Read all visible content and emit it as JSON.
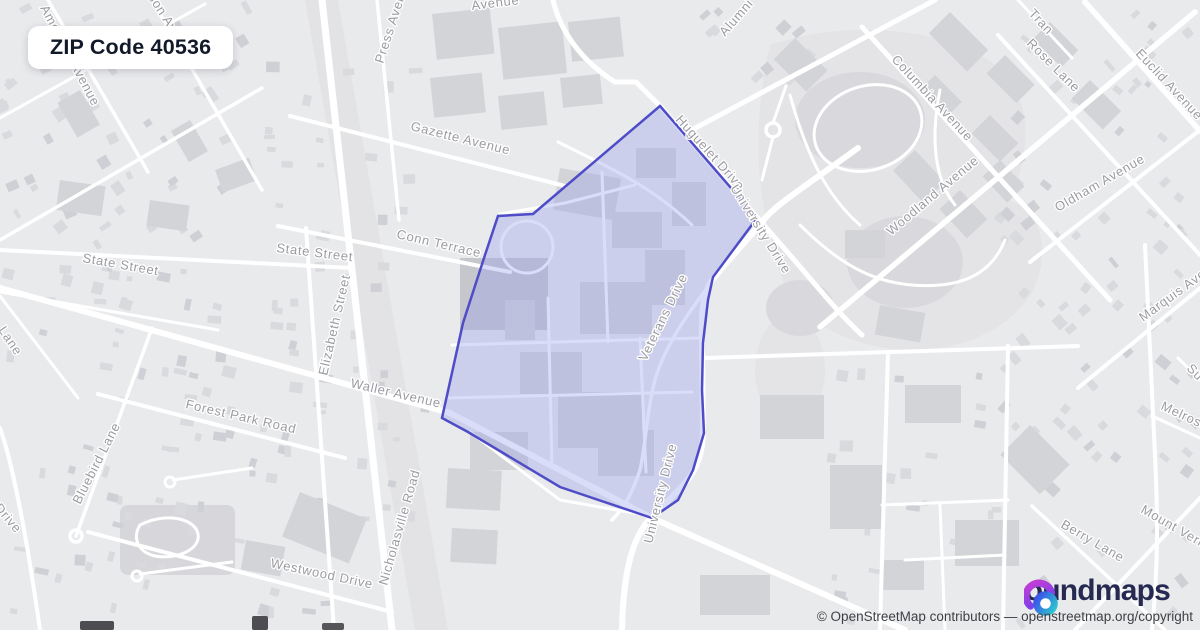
{
  "card": {
    "title": "ZIP Code 40536"
  },
  "branding": {
    "logo_full": "boundmaps",
    "logo_text": "oundmaps",
    "icon": "boundmaps-icon"
  },
  "attribution": {
    "text": "© OpenStreetMap contributors — openstreetmap.org/copyright"
  },
  "map": {
    "colors": {
      "background": "#e9eaec",
      "road": "#ffffff",
      "building": "#d3d4d8",
      "label": "#9b9ba2",
      "boundary_stroke": "#4f4cc8",
      "boundary_fill": "rgba(150,157,235,0.35)"
    },
    "zip_boundary": {
      "zip": "40536",
      "points": "660,106 757,218 713,277 708,300 703,343 702,390 704,433 693,470 678,500 652,518 560,487 468,432 442,418 463,323 485,255 498,216 533,214"
    },
    "street_labels": [
      {
        "text": "American Avenue",
        "x": 40,
        "y": 8,
        "rot": 62
      },
      {
        "text": "Simpson Avenue",
        "x": 130,
        "y": -30,
        "rot": 57
      },
      {
        "text": "Avenue",
        "x": 472,
        "y": 10,
        "rot": -7
      },
      {
        "text": "Press Avenue",
        "x": 383,
        "y": 64,
        "rot": -72
      },
      {
        "text": "Gazette Avenue",
        "x": 410,
        "y": 130,
        "rot": 14
      },
      {
        "text": "Conn Terrace",
        "x": 396,
        "y": 238,
        "rot": 13
      },
      {
        "text": "State Street",
        "x": 82,
        "y": 262,
        "rot": 10
      },
      {
        "text": "State Street",
        "x": 276,
        "y": 252,
        "rot": 7
      },
      {
        "text": "Elizabeth Street",
        "x": 327,
        "y": 376,
        "rot": -77
      },
      {
        "text": "Waller Avenue",
        "x": 350,
        "y": 387,
        "rot": 13
      },
      {
        "text": "Forest Park Road",
        "x": 185,
        "y": 408,
        "rot": 13
      },
      {
        "text": "Bluebird Lane",
        "x": 80,
        "y": 505,
        "rot": -63
      },
      {
        "text": "Lane",
        "x": -2,
        "y": 330,
        "rot": 56
      },
      {
        "text": "Drive",
        "x": -6,
        "y": 508,
        "rot": 50
      },
      {
        "text": "Nicholasville Road",
        "x": 387,
        "y": 586,
        "rot": -74
      },
      {
        "text": "Westwood Drive",
        "x": 270,
        "y": 567,
        "rot": 12
      },
      {
        "text": "Huguelet Drive",
        "x": 675,
        "y": 120,
        "rot": 48
      },
      {
        "text": "University Drive",
        "x": 730,
        "y": 188,
        "rot": 58
      },
      {
        "text": "University Drive",
        "x": 652,
        "y": 544,
        "rot": -76
      },
      {
        "text": "Veterans Drive",
        "x": 646,
        "y": 362,
        "rot": -64
      },
      {
        "text": "Alumni Con",
        "x": 725,
        "y": 37,
        "rot": -49
      },
      {
        "text": "Tran",
        "x": 1028,
        "y": 14,
        "rot": 47
      },
      {
        "text": "Columbia Avenue",
        "x": 891,
        "y": 60,
        "rot": 47
      },
      {
        "text": "Woodland Avenue",
        "x": 891,
        "y": 236,
        "rot": -40
      },
      {
        "text": "Rose Lane",
        "x": 1026,
        "y": 44,
        "rot": 45
      },
      {
        "text": "Euclid Avenue",
        "x": 1135,
        "y": 54,
        "rot": 47
      },
      {
        "text": "Oldham Avenue",
        "x": 1058,
        "y": 212,
        "rot": -30
      },
      {
        "text": "Marquis Avenue",
        "x": 1143,
        "y": 322,
        "rot": -36
      },
      {
        "text": "Su",
        "x": 1186,
        "y": 369,
        "rot": 45
      },
      {
        "text": "Melrose",
        "x": 1160,
        "y": 409,
        "rot": 25
      },
      {
        "text": "Mount Vernon",
        "x": 1140,
        "y": 512,
        "rot": 30
      },
      {
        "text": "Berry Lane",
        "x": 1060,
        "y": 527,
        "rot": 30
      }
    ]
  }
}
